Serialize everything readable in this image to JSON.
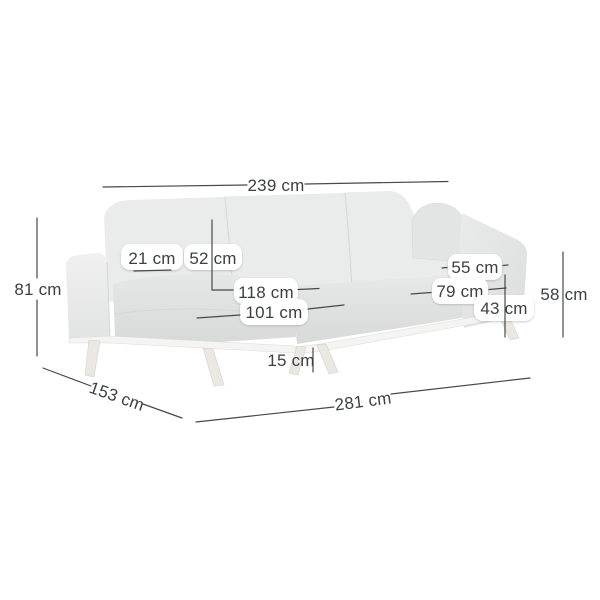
{
  "diagram": {
    "type": "furniture-dimension-diagram",
    "subject": "corner-sofa-with-chaise",
    "unit": "cm",
    "colors": {
      "line": "#46494c",
      "text": "#3c4043",
      "label_pill": "#ffffff",
      "sofa_light": "#eaebeb",
      "sofa_mid": "#e3e4e4",
      "sofa_dark": "#d9dada",
      "base_frame": "#f4f4f2",
      "leg_wood": "#ebe8e3",
      "background": "#ffffff"
    },
    "labels": {
      "top_width": "239 cm",
      "height_total": "81 cm",
      "armrest_width": "21 cm",
      "backrest_height": "52 cm",
      "chaise_depth": "118 cm",
      "chaise_cushion_length": "101 cm",
      "seat_depth": "55 cm",
      "seat_depth_total": "79 cm",
      "seat_height": "43 cm",
      "armrest_height": "58 cm",
      "leg_height": "15 cm",
      "side_depth": "153 cm",
      "total_width": "281 cm"
    }
  }
}
